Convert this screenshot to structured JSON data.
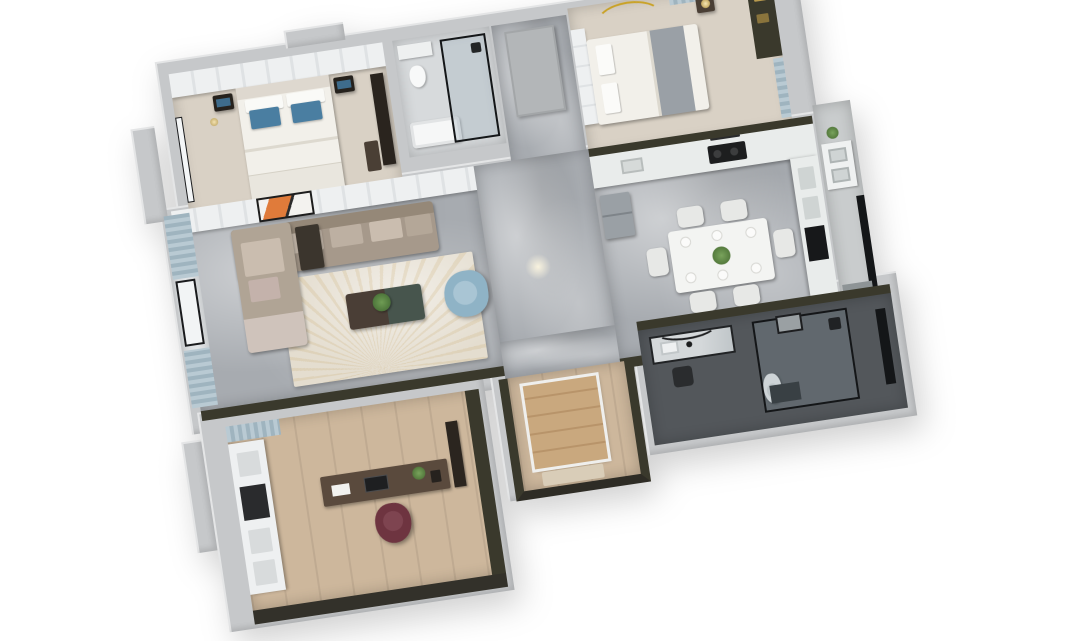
{
  "scene": {
    "kind": "3d-top-down-apartment-floor-plan-render",
    "background_is_blank_white": true,
    "rotation_degrees": -8.5,
    "rooms": [
      {
        "name": "master-bedroom",
        "furniture": [
          "wardrobe",
          "double-bed",
          "blue-pillows",
          "nightstand-left",
          "nightstand-right",
          "tv-panel",
          "foot-bench",
          "bay-window"
        ]
      },
      {
        "name": "bathroom-main",
        "furniture": [
          "bathtub",
          "glass-shower",
          "vanity"
        ]
      },
      {
        "name": "corridor-top",
        "furniture": [
          "door"
        ]
      },
      {
        "name": "bedroom-second",
        "furniture": [
          "double-bed",
          "gray-throw",
          "headboard-panel",
          "nightstand-lamp",
          "gold-arc-light",
          "window-curtain",
          "closet-shelf"
        ]
      },
      {
        "name": "living-room",
        "furniture": [
          "media-cabinet",
          "orange-artwork",
          "l-shaped-sofa",
          "side-table",
          "area-rug",
          "two-tone-coffee-table",
          "potted-plant",
          "blue-armchair"
        ]
      },
      {
        "name": "balcony-living",
        "furniture": [
          "striped-curtain",
          "window-frame"
        ]
      },
      {
        "name": "kitchen-dining",
        "furniture": [
          "counter-run",
          "cooktop",
          "range-hood",
          "refrigerator",
          "tall-cabinet",
          "dining-table",
          "dining-chairs-x6",
          "place-settings",
          "centerpiece-plant"
        ]
      },
      {
        "name": "utility-balcony",
        "furniture": [
          "double-sink-unit",
          "black-window",
          "plant"
        ]
      },
      {
        "name": "study",
        "furniture": [
          "display-shelf-wall",
          "desk",
          "monitor",
          "maroon-office-chair",
          "wall-shelf",
          "window-blind"
        ]
      },
      {
        "name": "entry-foyer",
        "furniture": [
          "wood-closet",
          "floor-mat"
        ]
      },
      {
        "name": "bathroom-second",
        "furniture": [
          "marble-vanity",
          "mirror",
          "toilet",
          "glass-shower",
          "black-window"
        ]
      }
    ]
  },
  "palette": {
    "background": "#ffffff",
    "wall": "#c6c8ca",
    "wall_light": "#e9eaeb",
    "wall_dark": "#3a392c",
    "marble": "#a7abb0",
    "marble_light": "#c6c9cc",
    "wood": "#cdb79c",
    "bedroom_floor": "#d9d1c5",
    "tile_light": "#d7dadc",
    "tile_dark": "#53575b",
    "bed_white": "#f2f0ea",
    "headboard": "#ded8cf",
    "pillow_blue": "#4a7ea1",
    "throw_gray": "#9aa0a6",
    "sofa": "#a6998b",
    "sofa_light": "#cabdaf",
    "armchair_blue": "#8fb3c6",
    "rug": "#e4ddcf",
    "coffee_green": "#47554d",
    "coffee_wood": "#4a3e36",
    "dining_white": "#f3f4f2",
    "chair_white": "#e7e8e6",
    "plant_green": "#5a7d4a",
    "counter": "#e9eceb",
    "appliance_dark": "#1d1e1f",
    "fridge_gray": "#9aa0a5",
    "desk_wood": "#5a4a3d",
    "chair_maroon": "#6e3440",
    "closet_wood": "#c9a87e",
    "curtain_blue": "#adbfc9",
    "art_orange": "#e07b3a",
    "lamp_gold": "#c9a227",
    "black_frame": "#141618"
  }
}
